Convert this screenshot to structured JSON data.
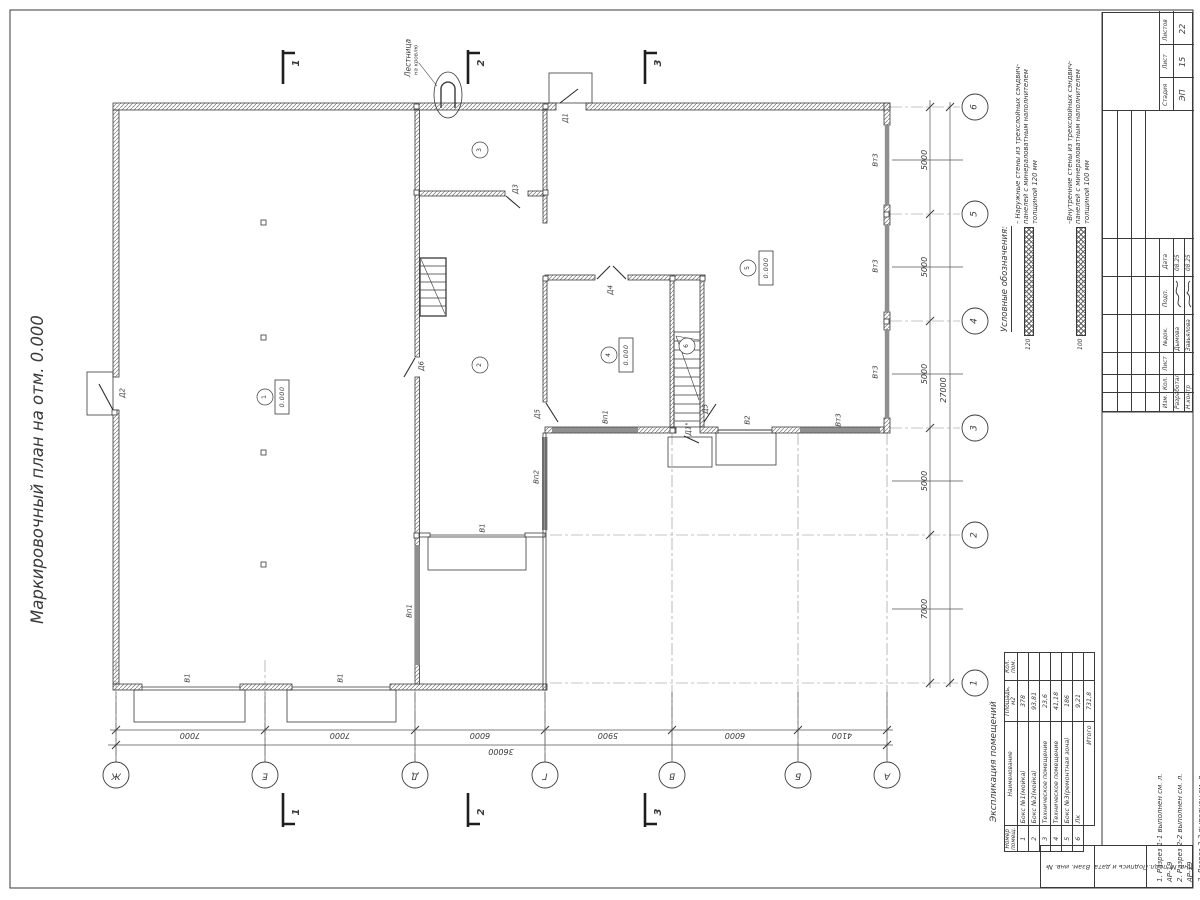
{
  "title": "Маркировочный план на отм. 0.000",
  "plan": {
    "labels": [
      {
        "text": "Д1",
        "x": 566,
        "y": 118
      },
      {
        "text": "Д2",
        "x": 123,
        "y": 393
      },
      {
        "text": "Д3",
        "x": 516,
        "y": 189
      },
      {
        "text": "Д4",
        "x": 611,
        "y": 290
      },
      {
        "text": "Д5",
        "x": 538,
        "y": 414
      },
      {
        "text": "Д5",
        "x": 706,
        "y": 409
      },
      {
        "text": "Д6",
        "x": 422,
        "y": 366
      },
      {
        "text": "Д1\"",
        "x": 689,
        "y": 429
      },
      {
        "text": "В1",
        "x": 188,
        "y": 678
      },
      {
        "text": "В1",
        "x": 341,
        "y": 678
      },
      {
        "text": "В1",
        "x": 483,
        "y": 528
      },
      {
        "text": "В2",
        "x": 748,
        "y": 420
      },
      {
        "text": "Вп1",
        "x": 410,
        "y": 611
      },
      {
        "text": "Вп1",
        "x": 606,
        "y": 417
      },
      {
        "text": "Вп2",
        "x": 537,
        "y": 477
      },
      {
        "text": "Вт3",
        "x": 876,
        "y": 160
      },
      {
        "text": "Вт3",
        "x": 876,
        "y": 266
      },
      {
        "text": "Вт3",
        "x": 876,
        "y": 372
      },
      {
        "text": "Вт3",
        "x": 839,
        "y": 420
      }
    ],
    "rooms": [
      {
        "n": "1",
        "x": 265,
        "y": 397
      },
      {
        "n": "2",
        "x": 480,
        "y": 365
      },
      {
        "n": "3",
        "x": 480,
        "y": 150
      },
      {
        "n": "4",
        "x": 609,
        "y": 355
      },
      {
        "n": "5",
        "x": 748,
        "y": 268
      },
      {
        "n": "6",
        "x": 687,
        "y": 346
      }
    ],
    "elevations": [
      {
        "v": "0.000",
        "x": 282,
        "y": 397
      },
      {
        "v": "0.000",
        "x": 626,
        "y": 355
      },
      {
        "v": "0.000",
        "x": 766,
        "y": 268
      }
    ],
    "ladder": {
      "line1": "Лестница",
      "line2": "на кровлю"
    }
  },
  "axes": {
    "bottom": [
      {
        "l": "Ж",
        "x": 116
      },
      {
        "l": "Е",
        "x": 265
      },
      {
        "l": "Д",
        "x": 415
      },
      {
        "l": "Г",
        "x": 545
      },
      {
        "l": "В",
        "x": 672
      },
      {
        "l": "Б",
        "x": 798
      },
      {
        "l": "А",
        "x": 887
      }
    ],
    "right": [
      {
        "l": "6",
        "y": 107
      },
      {
        "l": "5",
        "y": 214
      },
      {
        "l": "4",
        "y": 321
      },
      {
        "l": "3",
        "y": 428
      },
      {
        "l": "2",
        "y": 535
      },
      {
        "l": "1",
        "y": 683
      }
    ]
  },
  "dims": {
    "bottom": [
      {
        "v": "7000",
        "x": 190
      },
      {
        "v": "7000",
        "x": 340
      },
      {
        "v": "6000",
        "x": 480
      },
      {
        "v": "5900",
        "x": 608
      },
      {
        "v": "6000",
        "x": 735
      },
      {
        "v": "4100",
        "x": 842
      }
    ],
    "bottom_total": "36000",
    "right": [
      {
        "v": "5000",
        "y": 160
      },
      {
        "v": "5000",
        "y": 267
      },
      {
        "v": "5000",
        "y": 374
      },
      {
        "v": "5000",
        "y": 481
      },
      {
        "v": "7000",
        "y": 609
      }
    ],
    "right_total": "27000"
  },
  "sections": {
    "marks": [
      {
        "n": "1",
        "x": 283
      },
      {
        "n": "2",
        "x": 468
      },
      {
        "n": "3",
        "x": 645
      }
    ]
  },
  "legend": {
    "title": "Условные обозначения:",
    "entries": [
      {
        "dim": "120",
        "text": "– Наружные стены из трехслойных сэндвич-панелей с минераловатным наполнителем толщиной 120 мм"
      },
      {
        "dim": "100",
        "text": "–Внутренние стены из трехслойных сэндвич-панелей с минераловатным наполнителем толщиной 100 мм"
      }
    ]
  },
  "rooms_table": {
    "title": "Экспликация помещений",
    "headers": {
      "num": "Номер помещ.",
      "name": "Наименование",
      "area": "Площадь, м2",
      "count": "Кол. пом."
    },
    "rows": [
      {
        "num": "1",
        "name": "Бокс №1(мойка)",
        "area": "378",
        "count": ""
      },
      {
        "num": "2",
        "name": "Бокс №2(мойка)",
        "area": "93,81",
        "count": ""
      },
      {
        "num": "3",
        "name": "Техническое помещение",
        "area": "23,6",
        "count": ""
      },
      {
        "num": "4",
        "name": "Техническое помещение",
        "area": "41,18",
        "count": ""
      },
      {
        "num": "5",
        "name": "Бокс №3(ремонтная зона)",
        "area": "186",
        "count": ""
      },
      {
        "num": "6",
        "name": "Лк",
        "area": "9,21",
        "count": ""
      }
    ],
    "total_label": "Итого",
    "total": "731,8"
  },
  "notes": [
    "1. Разрез 1-1 выполнен см. л. АР-19",
    "2. Разрез 2-2 выполнен см. л. АР-19",
    "3. Разрез 3-3 выполнен см. л. АР-19"
  ],
  "stamp": {
    "stage_label": "Стадия",
    "stage": "ЭП",
    "sheet_label": "Лист",
    "sheet": "15",
    "sheets_label": "Листов",
    "sheets": "22",
    "cols": [
      "Изм.",
      "Кол.",
      "Лист",
      "№док.",
      "Подп.",
      "Дата"
    ],
    "rows": [
      {
        "role": "Разработал",
        "name": "Дымова",
        "date": "08.25"
      },
      {
        "role": "Н.контр",
        "name": "Завьялова",
        "date": "08.25"
      }
    ],
    "side_labels": [
      "Взам. инв. №",
      "Подпись и дата",
      "Инв. № подл."
    ]
  }
}
